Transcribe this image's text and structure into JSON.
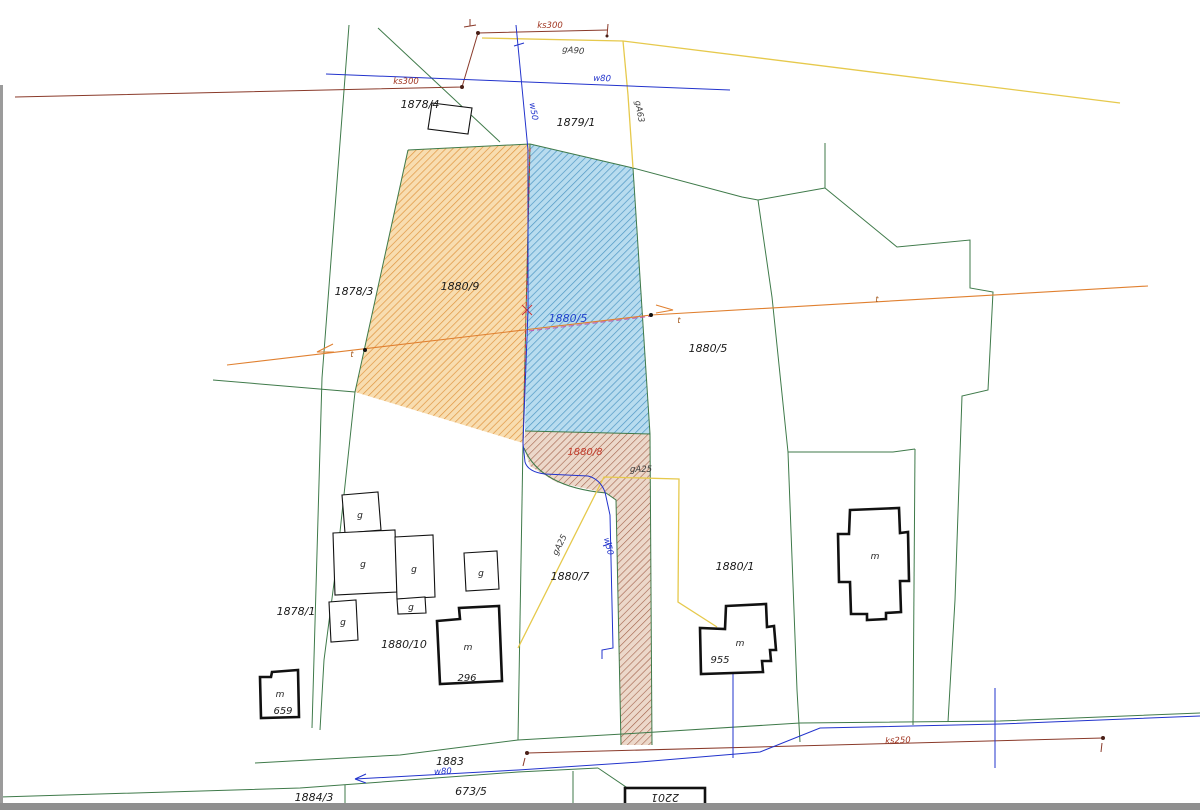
{
  "parcel_labels": {
    "p1878_4": "1878/4",
    "p1879_1": "1879/1",
    "p1878_3": "1878/3",
    "p1880_9": "1880/9",
    "p1880_5_blue": "1880/5",
    "p1880_5": "1880/5",
    "p1880_8": "1880/8",
    "p1880_7": "1880/7",
    "p1880_1": "1880/1",
    "p1878_1": "1878/1",
    "p1880_10": "1880/10",
    "p1883": "1883",
    "p673_5": "673/5",
    "p1884_3": "1884/3",
    "p2201": "2201"
  },
  "building_labels": {
    "g": "g",
    "m": "m",
    "n296": "296",
    "n955": "955",
    "n659": "659"
  },
  "utility_labels": {
    "ks300": "ks300",
    "ks250": "ks250",
    "w80": "w80",
    "w50": "w50",
    "ga90": "gA90",
    "ga63": "gA63",
    "ga25": "gA25",
    "t_marker": "t"
  },
  "colors": {
    "boundary_green": "#3f7a4a",
    "water_blue": "#2233cc",
    "gas_yellow": "#e6c94c",
    "sewer_red": "#8a3a2a",
    "power_orange": "#e08030",
    "survey_magenta": "#c255aa",
    "survey_red_dashed": "#cc3333",
    "parcel_orange_fill": "#f8ddb0",
    "parcel_orange_hatch": "#e09540",
    "parcel_blue_fill": "#b8dcef",
    "parcel_blue_hatch": "#4e97c4",
    "parcel_brown_fill": "#ecd8ca",
    "parcel_brown_hatch": "#a2614a",
    "building_outline": "#111111"
  }
}
